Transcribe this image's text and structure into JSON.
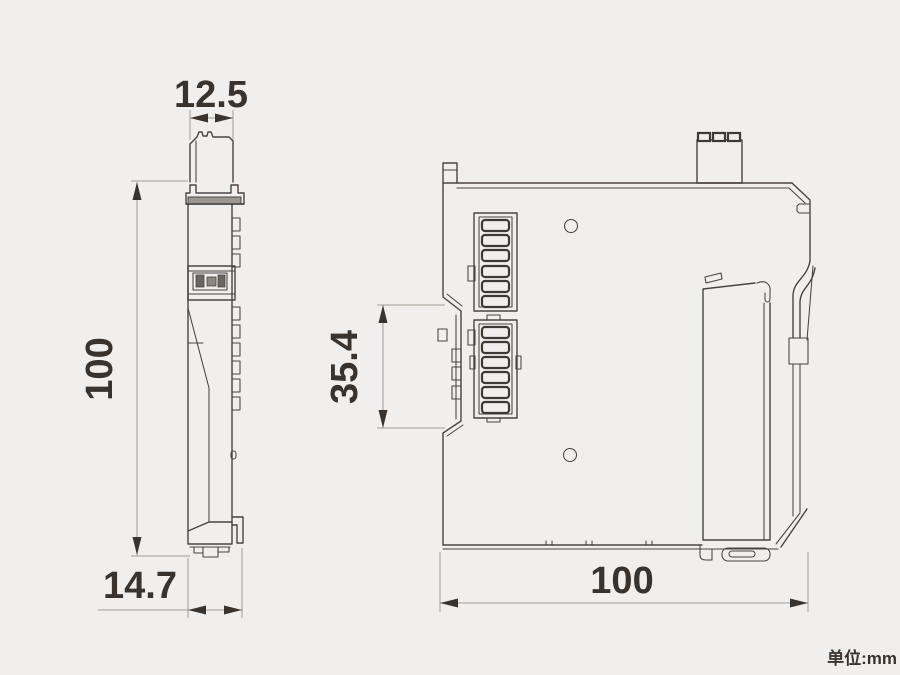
{
  "unit_label": "单位:mm",
  "views": {
    "front": {
      "dims": {
        "top_width": "12.5",
        "height": "100",
        "bottom_width": "14.7"
      }
    },
    "side": {
      "dims": {
        "groove_height": "35.4",
        "depth": "100"
      }
    }
  },
  "colors": {
    "background": "#f0efee",
    "outline": "#4a4340",
    "dimension_text": "#3a322c",
    "dimension_line": "#a29c96"
  }
}
